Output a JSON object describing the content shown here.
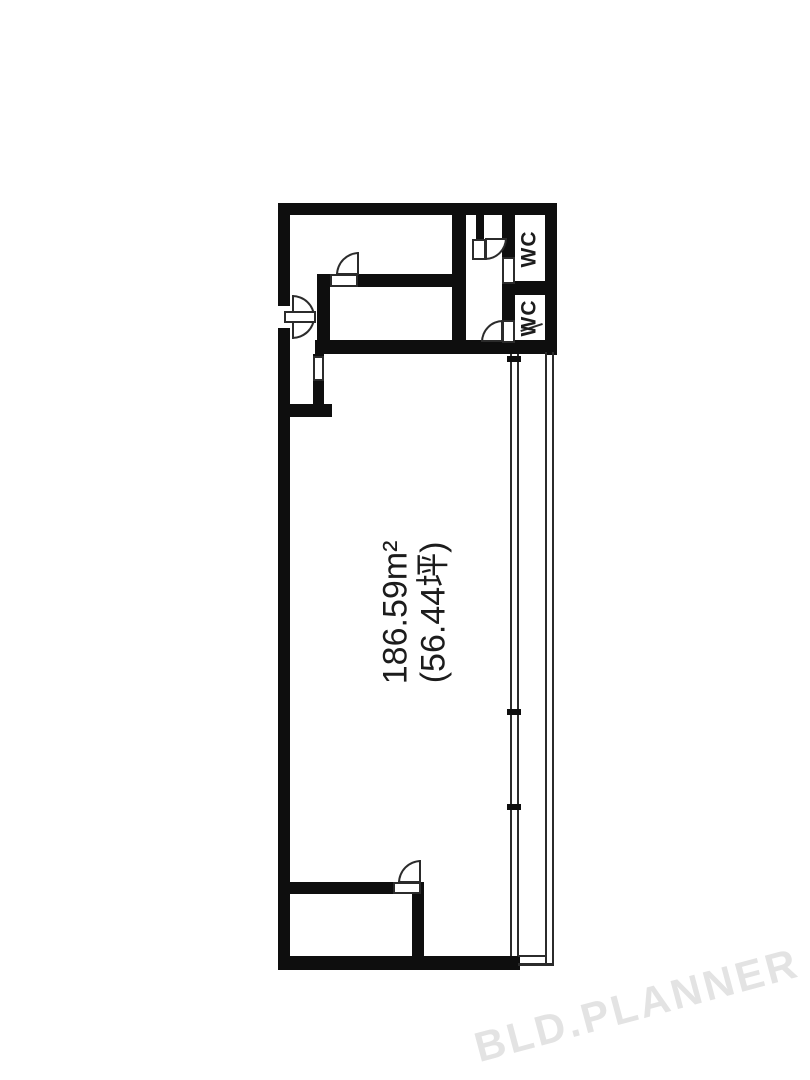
{
  "plan": {
    "area_label": {
      "line1": "186.59m²",
      "line2": "(56.44坪)"
    },
    "wc_top": {
      "label": "WC"
    },
    "wc_bottom": {
      "label": "WC"
    },
    "watermark": {
      "text": "BLD.PLANNER"
    }
  },
  "colors": {
    "wall": "#0e0e0e",
    "line": "#2b2b2b",
    "text": "#1c1c1c",
    "watermark": "#e3e3e3",
    "background": "#ffffff"
  }
}
